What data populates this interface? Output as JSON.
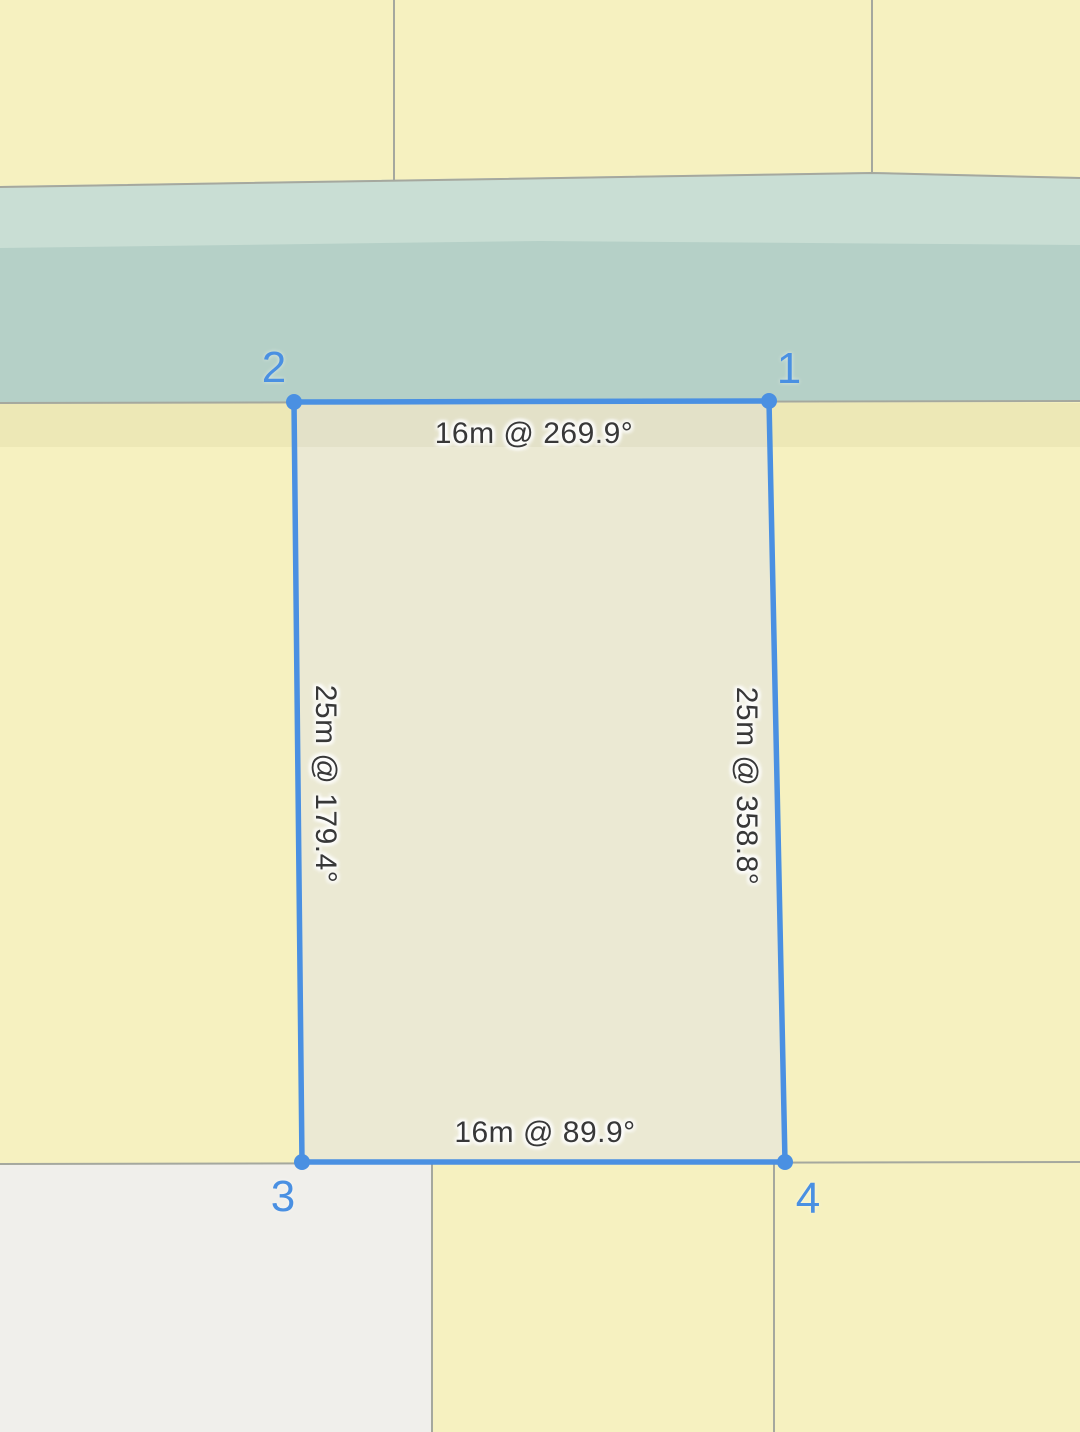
{
  "app": {
    "view": "parcel-measurement-map"
  },
  "parcel": {
    "edges": {
      "top": {
        "label": "16m @ 269.9°",
        "length_m": 16,
        "bearing_deg": 269.9
      },
      "right": {
        "label": "25m @ 358.8°",
        "length_m": 25,
        "bearing_deg": 358.8
      },
      "bottom": {
        "label": "16m @ 89.9°",
        "length_m": 16,
        "bearing_deg": 89.9
      },
      "left": {
        "label": "25m @ 179.4°",
        "length_m": 25,
        "bearing_deg": 179.4
      }
    },
    "vertices": [
      {
        "id": 1,
        "label": "1"
      },
      {
        "id": 2,
        "label": "2"
      },
      {
        "id": 3,
        "label": "3"
      },
      {
        "id": 4,
        "label": "4"
      }
    ]
  },
  "colors": {
    "selection_blue": "#4a90e2",
    "parcel_yellow": "#f6f1c0",
    "selected_parcel_fill": "#ebe9d3",
    "road_light_teal": "#c9ded4",
    "road_dark_teal": "#b5d0c7",
    "open_area_white": "#f0efeb",
    "boundary_gray": "#a5a89e",
    "measurement_text": "#383838"
  }
}
